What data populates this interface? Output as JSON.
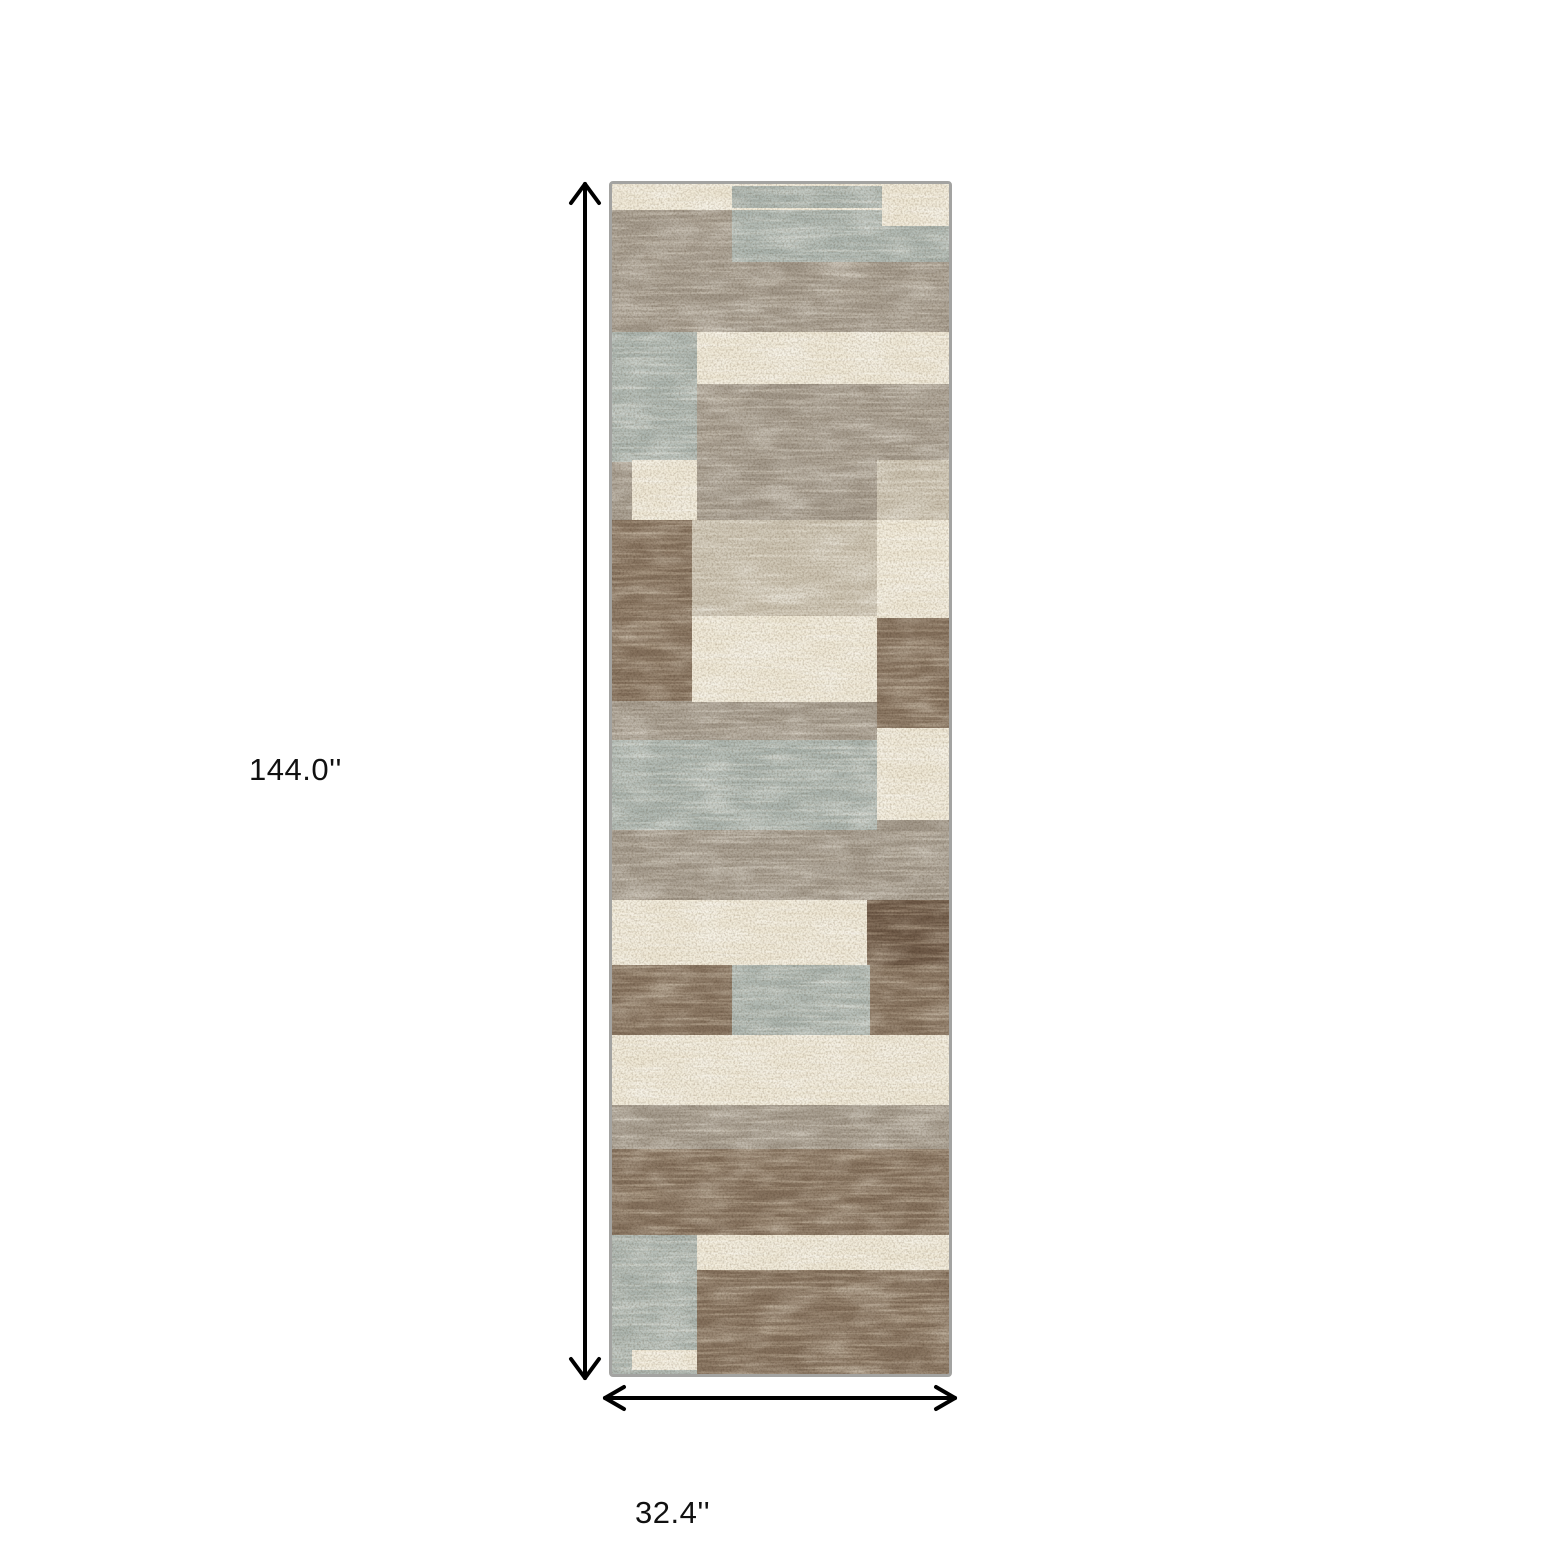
{
  "figure": {
    "background_color": "#ffffff",
    "annotation_color": "#000000",
    "height_label": "144.0''",
    "width_label": "32.4''"
  },
  "rug": {
    "description": "vertical runner rug with mottled patchwork rectangles",
    "border_color": "#a3a3a1",
    "colors": {
      "tp": "#a2988a",
      "cr": "#efe8d6",
      "sg": "#aab3ad",
      "br": "#84705c",
      "db": "#6d5846",
      "lt": "#c9c0ae"
    },
    "patches": [
      [
        0,
        0,
        337,
        1190,
        "tp"
      ],
      [
        0,
        0,
        337,
        26,
        "cr"
      ],
      [
        120,
        2,
        150,
        22,
        "sg"
      ],
      [
        0,
        26,
        337,
        52,
        "sg"
      ],
      [
        0,
        26,
        120,
        52,
        "tp"
      ],
      [
        270,
        0,
        67,
        42,
        "cr"
      ],
      [
        0,
        148,
        85,
        130,
        "sg"
      ],
      [
        85,
        148,
        252,
        52,
        "cr"
      ],
      [
        20,
        276,
        65,
        62,
        "cr"
      ],
      [
        265,
        276,
        72,
        62,
        "lt"
      ],
      [
        0,
        336,
        80,
        96,
        "br"
      ],
      [
        80,
        336,
        185,
        96,
        "lt"
      ],
      [
        265,
        336,
        72,
        98,
        "cr"
      ],
      [
        0,
        432,
        80,
        85,
        "br"
      ],
      [
        80,
        432,
        185,
        86,
        "cr"
      ],
      [
        265,
        434,
        72,
        110,
        "br"
      ],
      [
        0,
        556,
        265,
        90,
        "sg"
      ],
      [
        265,
        544,
        72,
        92,
        "cr"
      ],
      [
        0,
        716,
        255,
        65,
        "cr"
      ],
      [
        255,
        716,
        82,
        65,
        "db"
      ],
      [
        0,
        781,
        120,
        70,
        "br"
      ],
      [
        120,
        781,
        138,
        70,
        "sg"
      ],
      [
        258,
        781,
        79,
        70,
        "br"
      ],
      [
        0,
        851,
        337,
        70,
        "cr"
      ],
      [
        0,
        965,
        337,
        86,
        "br"
      ],
      [
        0,
        1051,
        85,
        139,
        "sg"
      ],
      [
        85,
        1051,
        252,
        35,
        "cr"
      ],
      [
        85,
        1086,
        252,
        104,
        "br"
      ],
      [
        20,
        1166,
        65,
        20,
        "cr"
      ]
    ]
  }
}
